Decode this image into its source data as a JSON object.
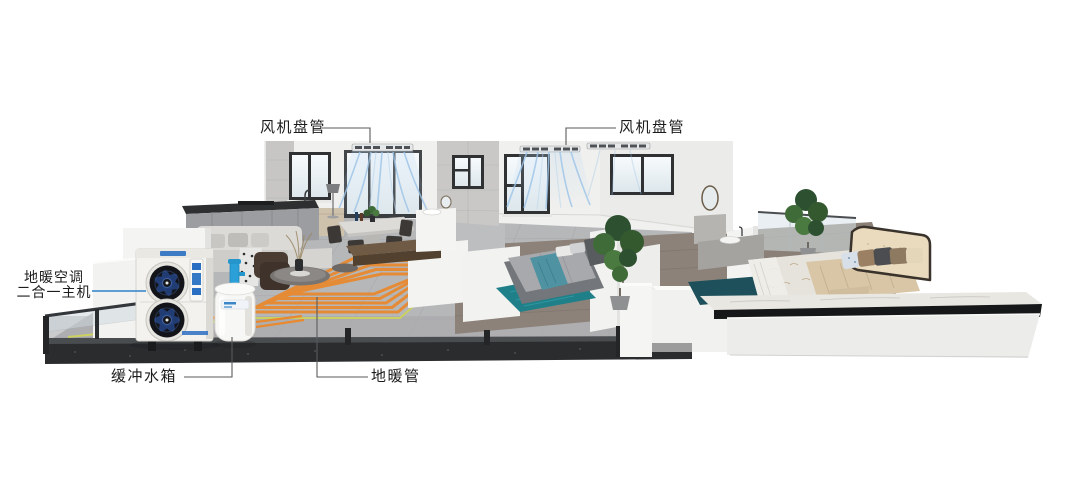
{
  "labels": {
    "fan_coil_left": "风机盘管",
    "fan_coil_right": "风机盘管",
    "main_unit_line1": "地暖空调",
    "main_unit_line2": "二合一主机",
    "buffer_tank": "缓冲水箱",
    "floor_pipe": "地暖管"
  },
  "colors": {
    "label_text": "#1c1c1c",
    "leader_line": "#5a5a5a",
    "leader_line_blue": "#2e82c8",
    "pipe_orange": "#e8892f",
    "pipe_yellow_green": "#ccd25c",
    "airflow_blue": "#9cc4e8",
    "unit_accent_blue": "#2b6fc2",
    "tank_pipe_blue": "#2ba0d8",
    "rug_teal": "#1f7e87",
    "base_granite": "#2a2c2e"
  }
}
